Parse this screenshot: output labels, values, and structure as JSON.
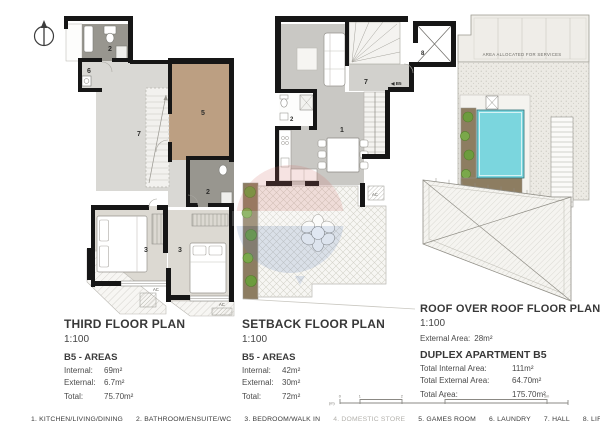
{
  "sheet": {
    "plans": {
      "third": {
        "title": "THIRD FLOOR PLAN",
        "scale": "1:100",
        "areas_heading": "B5 - AREAS",
        "rows": [
          {
            "label": "Internal:",
            "value": "69m²"
          },
          {
            "label": "External:",
            "value": "6.7m²"
          },
          {
            "label": "Total:",
            "value": "75.70m²"
          }
        ],
        "room_labels": {
          "bathroom_top": "2",
          "laundry": "6",
          "hall": "7",
          "games_room": "5",
          "bathroom_lower": "2",
          "bedroom_left": "3",
          "bedroom_right": "3",
          "ac_left": "AC",
          "ac_right": "AC"
        }
      },
      "setback": {
        "title": "SETBACK FLOOR PLAN",
        "scale": "1:100",
        "areas_heading": "B5 - AREAS",
        "rows": [
          {
            "label": "Internal:",
            "value": "42m²"
          },
          {
            "label": "External:",
            "value": "30m²"
          },
          {
            "label": "Total:",
            "value": "72m²"
          }
        ],
        "room_labels": {
          "bathroom": "2",
          "kitchen_living_dining": "1",
          "hall": "7",
          "lift": "8",
          "entry": "◀ B5",
          "ac": "AC"
        }
      },
      "roof": {
        "title": "ROOF OVER ROOF FLOOR PLAN",
        "scale": "1:100",
        "external_row": {
          "label": "External Area:",
          "value": "28m²"
        },
        "services_label": "AREA ALLOCATED FOR SERVICES"
      }
    },
    "summary": {
      "heading": "DUPLEX APARTMENT B5",
      "rows": [
        {
          "label": "Total Internal Area:",
          "value": "111m²"
        },
        {
          "label": "Total External Area:",
          "value": "64.70m²"
        },
        {
          "label": "Total Area:",
          "value": "175.70m²"
        }
      ]
    },
    "legend": {
      "items": [
        {
          "text": "1. KITCHEN/LIVING/DINING"
        },
        {
          "text": "2. BATHROOM/ENSUITE/WC"
        },
        {
          "text": "3. BEDROOM/WALK IN"
        },
        {
          "text": "4. DOMESTIC STORE"
        },
        {
          "text": "5. GAMES ROOM"
        },
        {
          "text": "6. LAUNDRY"
        },
        {
          "text": "7. HALL"
        },
        {
          "text": "8. LIFT"
        }
      ]
    },
    "scale_bar": {
      "unit_label": "(m)",
      "tick_labels": [
        "0",
        "1",
        "2",
        "3"
      ],
      "end_label": "5m"
    },
    "colors": {
      "wall": "#161616",
      "pool": "#7bd6de",
      "planter_green": "#6d9c3e",
      "soil_brown": "#8d7d61",
      "games_room_tan": "#bc9f82",
      "watermark_red": "#cf6a64",
      "watermark_blue": "#5b7fb9"
    }
  }
}
